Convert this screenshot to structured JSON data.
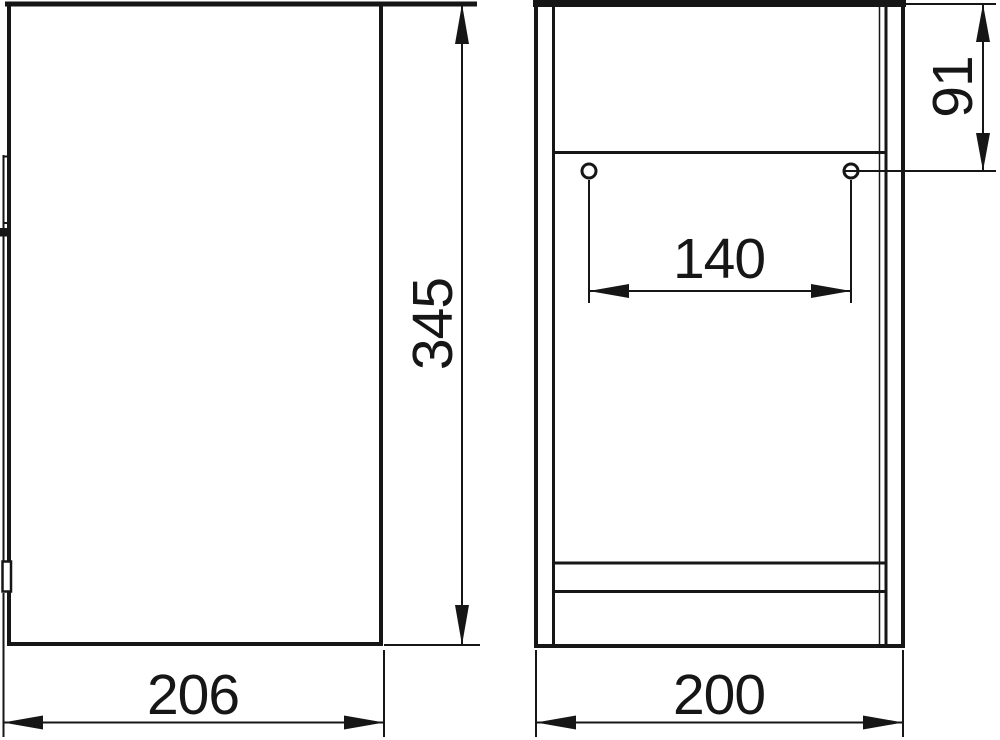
{
  "page": {
    "background": "#ffffff",
    "ink": "#161616"
  },
  "drawing": {
    "kind": "cabinet dimensional technical drawing",
    "views": [
      {
        "id": "side",
        "description": "side profile view with door front line and hinge details"
      },
      {
        "id": "front",
        "description": "front elevation view with top apron, two mounting holes and bottom rail"
      }
    ],
    "mounting_holes": 2
  },
  "dimensions": {
    "depth": {
      "value": "206",
      "view": "side",
      "orientation": "horizontal"
    },
    "height": {
      "value": "345",
      "view": "side",
      "orientation": "vertical"
    },
    "width": {
      "value": "200",
      "view": "front",
      "orientation": "horizontal"
    },
    "hole_spacing": {
      "value": "140",
      "view": "front",
      "orientation": "horizontal"
    },
    "hole_offset": {
      "value": "91",
      "view": "front",
      "orientation": "vertical"
    }
  }
}
